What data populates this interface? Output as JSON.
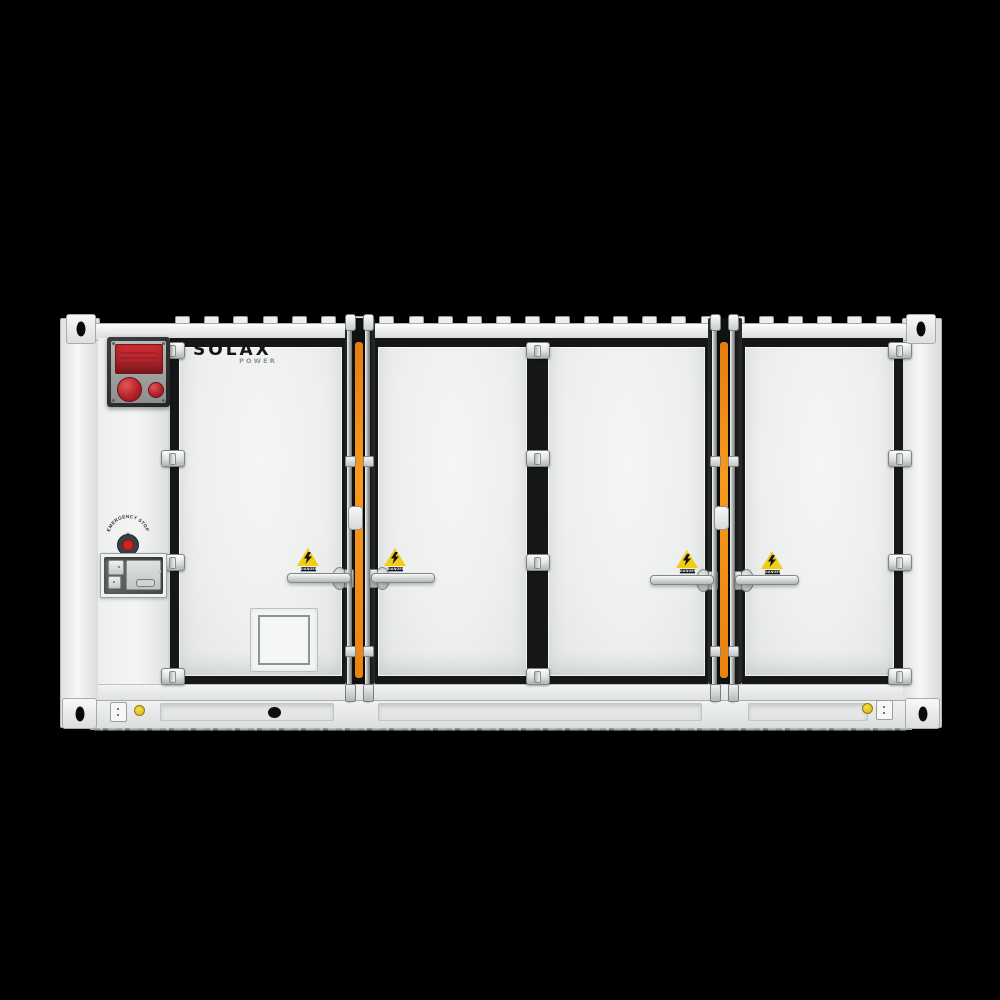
{
  "scene": {
    "description": "Front view of a white containerized battery energy storage system with four doors",
    "background_color": "#000000"
  },
  "branding": {
    "logo_main": "SOLAX",
    "logo_sub": "POWER"
  },
  "emergency_stop": {
    "label": "EMERGENCY STOP"
  },
  "warning_labels": {
    "text": "DANGER",
    "symbol": "high-voltage-lightning",
    "count": 4
  },
  "equipment": {
    "fire_alarm_box": "red display with two round alarm buttons",
    "doors": [
      "door-1",
      "door-2",
      "door-3",
      "door-4"
    ],
    "accent_colors": {
      "orange_stripe": "#ef8a1c",
      "alarm_red": "#c62f34",
      "label_yellow": "#f2cd15",
      "body_white": "#eef0ef",
      "frame_black": "#161818"
    }
  }
}
